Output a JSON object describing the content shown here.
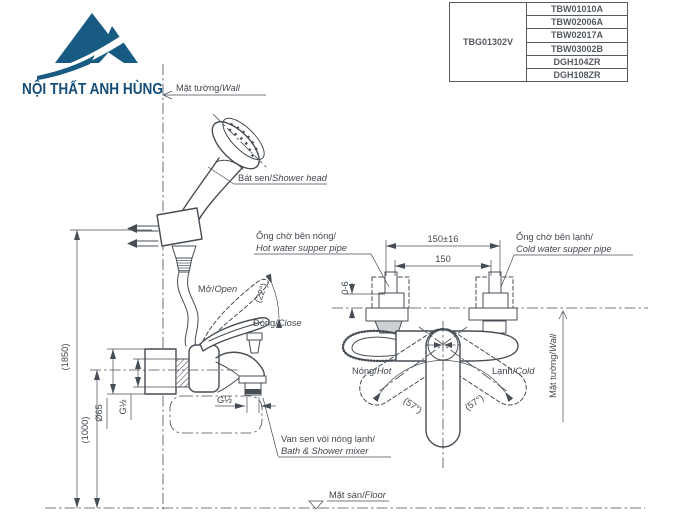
{
  "brand": {
    "name": "NỘI THẤT ANH HÙNG"
  },
  "product_table": {
    "main_code": "TBG01302V",
    "related_codes": [
      "TBW01010A",
      "TBW02006A",
      "TBW02017A",
      "TBW03002B",
      "DGH104ZR",
      "DGH108ZR"
    ]
  },
  "labels": {
    "wall_top_vi": "Mặt tường/",
    "wall_top_en": "Wall",
    "shower_head_vi": "Bát sen/",
    "shower_head_en": "Shower head",
    "open_vi": "Mở/",
    "open_en": "Open",
    "close_vi": "Đóng/",
    "close_en": "Close",
    "hot_pipe_vi": "Ống chờ bên nóng/",
    "hot_pipe_en": "Hot water supper pipe",
    "cold_pipe_vi": "Ống chờ bên lạnh/",
    "cold_pipe_en": "Cold water supper pipe",
    "hot_vi": "Nóng/",
    "hot_en": "Hot",
    "cold_vi": "Lạnh/",
    "cold_en": "Cold",
    "wall_right_vi": "Mặt tường/",
    "wall_right_en": "Wall",
    "mixer_vi": "Van sen vòi nóng lạnh/",
    "mixer_en": "Bath & Shower mixer",
    "floor_vi": "Mặt sàn/",
    "floor_en": "Floor"
  },
  "dimensions": {
    "shower_height": "(1850)",
    "mixer_height": "(1000)",
    "plate_diameter": "Ø65",
    "thread_wall": "G½",
    "thread_spout": "G½",
    "pipe_span_tolerance": "150±16",
    "pipe_span": "150",
    "wall_gap": "0-6",
    "open_angle": "(22°)",
    "swing_left": "(57°)",
    "swing_right": "(57°)"
  },
  "colors": {
    "brand_blue": "#175a82",
    "line_gray": "#474d55"
  }
}
